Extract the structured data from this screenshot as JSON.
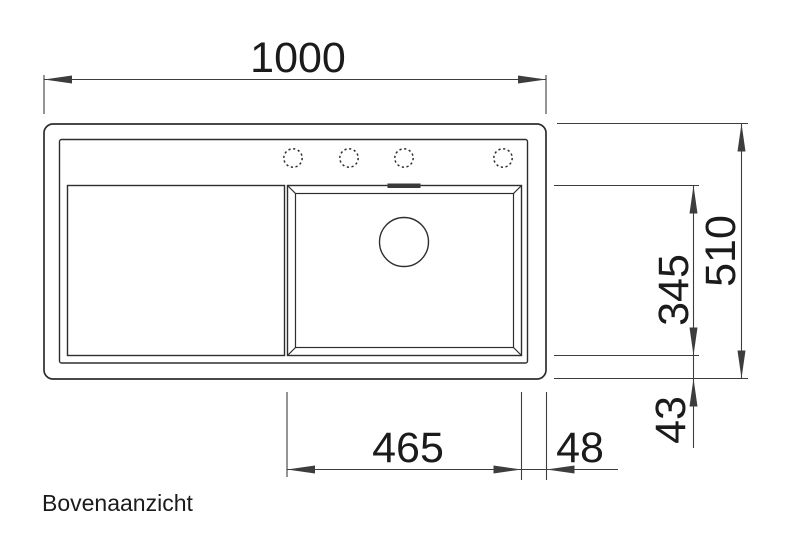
{
  "view_label": "Bovenaanzicht",
  "dimensions": {
    "overall_width": "1000",
    "overall_depth": "510",
    "bowl_inner_depth": "345",
    "bowl_to_edge_bottom": "43",
    "bowl_inner_width": "465",
    "bowl_to_edge_right": "48"
  },
  "drawing": {
    "type": "technical-top-view",
    "subject": "kitchen sink with left drainboard and right bowl",
    "faucet_hole_count": 4,
    "has_drain": true,
    "has_overflow": true
  },
  "colors": {
    "background": "#ffffff",
    "line": "#2e2e2e",
    "dimension_line": "#3d3d3d",
    "text": "#1b1b1b"
  }
}
